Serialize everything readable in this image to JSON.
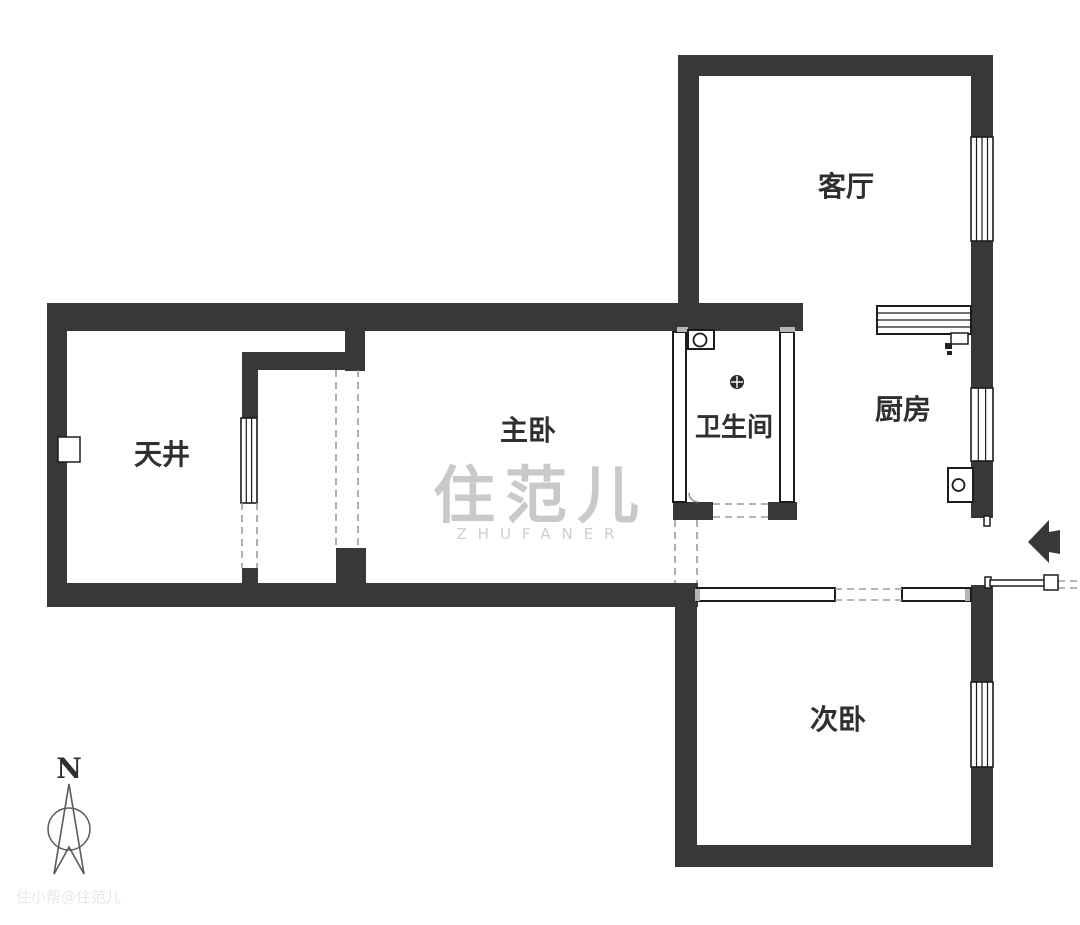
{
  "rooms": {
    "living_room": {
      "label": "客厅"
    },
    "kitchen": {
      "label": "厨房"
    },
    "master_bedroom": {
      "label": "主卧"
    },
    "bathroom": {
      "label": "卫生间"
    },
    "courtyard": {
      "label": "天井"
    },
    "second_bedroom": {
      "label": "次卧"
    }
  },
  "watermark": {
    "logo": "住范儿",
    "latin": "ZHUFANER",
    "corner": "住小帮@住范儿"
  },
  "compass": {
    "north": "N"
  },
  "icons": {
    "entrance_arrow": "solid left-pointing arrow at entry",
    "entrance_door": "open door leaf with handle",
    "kitchen_counter": "striped counter block",
    "gas_meter": "small meter box",
    "water_heater": "box with burner circle",
    "washing_machine": "box with drum circle",
    "floor_drain": "dark circle with cross",
    "compass_needle": "narrow north needle in circle",
    "window": "triple-line glazing in wall"
  },
  "colors": {
    "wall": "#383838",
    "line": "#1c1c1c",
    "label": "#2f2f2f",
    "dash": "#9b9b9b",
    "watermark": "#c9c9c9",
    "watermark_latin": "#cfcfcf",
    "corner_watermark": "#e8e8e8",
    "compass": "#5a5a5a",
    "drain": "#2c2c2c"
  }
}
